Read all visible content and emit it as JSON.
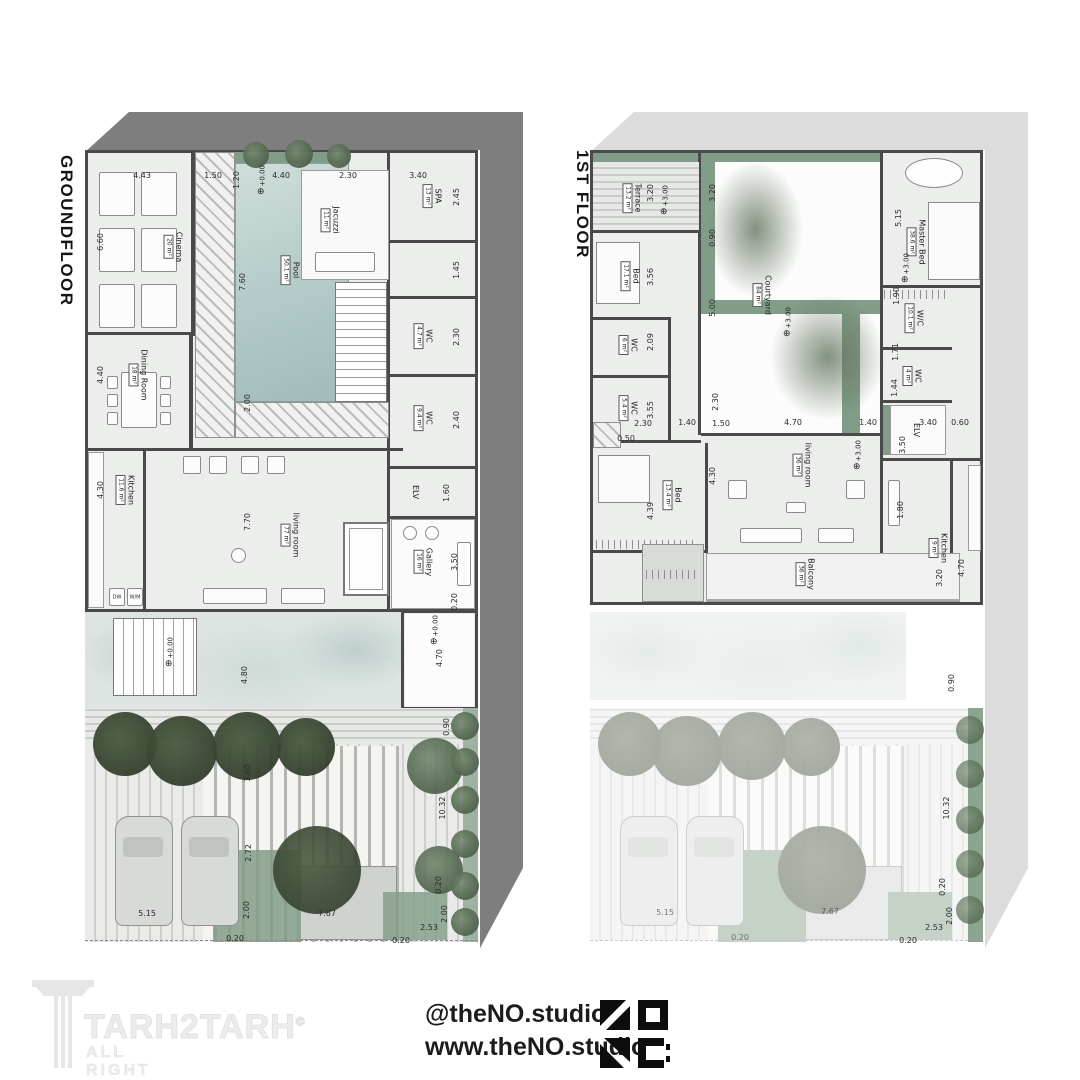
{
  "branding": {
    "watermark": {
      "name": "TARH2TARH",
      "copyright": "©",
      "tagline": "ALL RIGHT RESERVED"
    },
    "studio": {
      "handle": "@theNO.studio",
      "website": "www.theNO.studio",
      "logo": "no-studio-mark"
    }
  },
  "plans": {
    "gf": {
      "title": "GROUNDFLOOR",
      "level": "+0.00",
      "level_icon": "⊕",
      "appliances": {
        "dw": "DW",
        "wm": "W/M"
      },
      "rooms": {
        "cinema": {
          "name": "Cinema",
          "area": "20 m²"
        },
        "dining": {
          "name": "Dining Room",
          "area": "18 m²"
        },
        "kitchen": {
          "name": "Kitchen",
          "area": "11.6 m²"
        },
        "pool": {
          "name": "Pool",
          "area": "50.1 m²"
        },
        "jacuzzi": {
          "name": "Jacuzzi",
          "area": "11 m²"
        },
        "spa": {
          "name": "SPA",
          "area": "13 m²"
        },
        "wc1": {
          "name": "WC",
          "area": "4.7 m²"
        },
        "wc2": {
          "name": "WC",
          "area": "9.4 m²"
        },
        "elv": {
          "name": "ELV",
          "area": ""
        },
        "gallery": {
          "name": "Gallery",
          "area": "16 m²"
        },
        "living": {
          "name": "living room",
          "area": "77 m²"
        }
      },
      "dims": [
        "4.43",
        "1.50",
        "1.20",
        "4.40",
        "2.30",
        "3.40",
        "2.45",
        "1.45",
        "2.30",
        "2.40",
        "1.60",
        "3.50",
        "0.20",
        "4.70",
        "0.90",
        "10.32",
        "0.20",
        "2.00",
        "2.53",
        "0.20",
        "6.60",
        "4.40",
        "4.30",
        "7.60",
        "2.00",
        "7.70",
        "4.80",
        "3.60",
        "2.72",
        "2.00",
        "5.15",
        "7.67",
        "0.20"
      ]
    },
    "ff": {
      "title": "1ST FLOOR",
      "level": "+3.00",
      "level_icon": "⊕",
      "rooms": {
        "terrace": {
          "name": "Terrace",
          "area": "13.2 m²"
        },
        "bed1": {
          "name": "Bed",
          "area": "17.1 m²"
        },
        "wc1": {
          "name": "WC",
          "area": "6 m²"
        },
        "wc2": {
          "name": "WC",
          "area": "5.4 m²"
        },
        "bed2": {
          "name": "Bed",
          "area": "13.4 m²"
        },
        "courtyard": {
          "name": "Courtyard",
          "area": "84 m²"
        },
        "master": {
          "name": "Master Bed",
          "area": "38.6 m²"
        },
        "wic": {
          "name": "W/C",
          "area": "10.1 m²"
        },
        "wcm": {
          "name": "WC",
          "area": "4 m²"
        },
        "elv": {
          "name": "ELV",
          "area": ""
        },
        "kitchen": {
          "name": "Kitchen",
          "area": "9 m²"
        },
        "living": {
          "name": "living room",
          "area": "36 m²"
        },
        "balcony": {
          "name": "Balcony",
          "area": "36 m²"
        }
      },
      "dims": [
        "3.20",
        "0.90",
        "5.00",
        "3.20",
        "5.15",
        "1.90",
        "1.71",
        "1.44",
        "3.56",
        "2.09",
        "3.55",
        "2.30",
        "0.50",
        "1.40",
        "2.30",
        "1.50",
        "4.70",
        "1.40",
        "3.40",
        "0.60",
        "3.50",
        "4.30",
        "4.39",
        "1.80",
        "3.20",
        "4.70",
        "0.90",
        "10.32",
        "0.20",
        "2.00",
        "2.53",
        "0.20",
        "5.15",
        "7.67",
        "0.20"
      ]
    }
  }
}
